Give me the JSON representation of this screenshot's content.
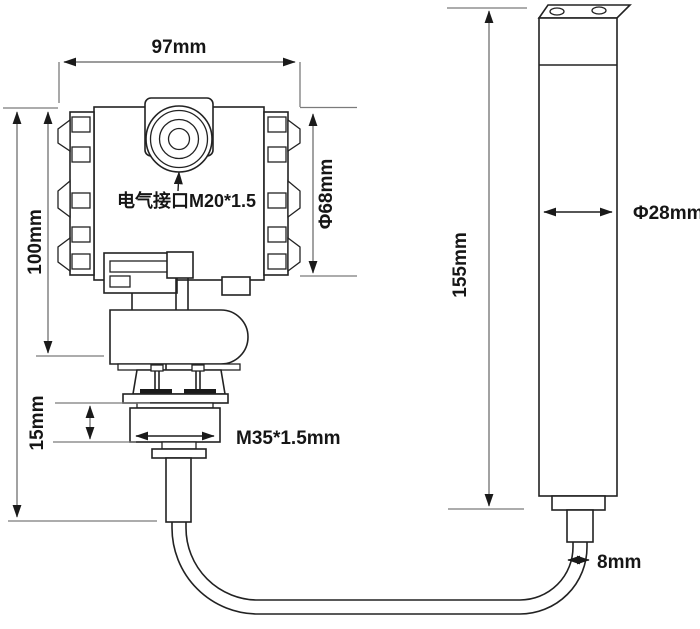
{
  "diagram": {
    "type": "technical-dimension-drawing",
    "subject": "submersible level transmitter with display head, threaded process connection, cable and sensing probe",
    "labels": {
      "housing_width": "97mm",
      "housing_height": "100mm",
      "housing_diameter": "Φ68mm",
      "electrical_interface": "电气接口M20*1.5",
      "gland_height": "15mm",
      "thread_spec": "M35*1.5mm",
      "probe_length": "155mm",
      "probe_diameter": "Φ28mm",
      "cable_diameter": "8mm"
    },
    "colors": {
      "background": "#ffffff",
      "drawing_line": "#222222",
      "dimension_line": "#7b7b7b",
      "arrowhead": "#1a1a1a",
      "text": "#161616"
    }
  }
}
